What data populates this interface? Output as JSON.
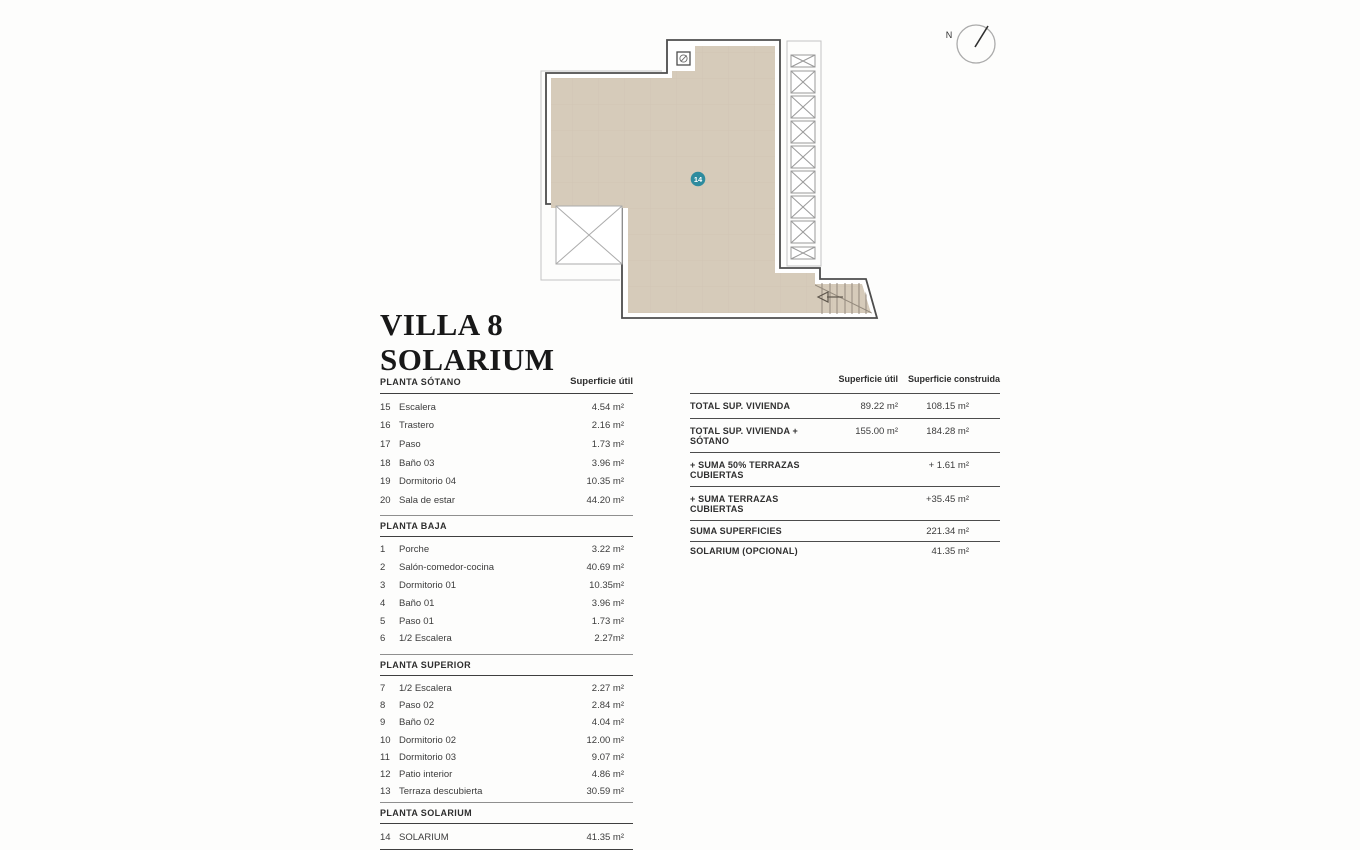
{
  "title": {
    "line1": "VILLA 8",
    "line2": "SOLARIUM"
  },
  "compass": {
    "label": "N"
  },
  "plan": {
    "marker": "14"
  },
  "colors": {
    "floor_fill": "#d6cbba",
    "tile_line": "#cdc1b0",
    "wall_line": "#4d4d4d",
    "light_line": "#bdbdbd",
    "marker_teal": "#2e8b9e"
  },
  "left_table": {
    "col_header": "Superficie útil",
    "sections": [
      {
        "header": "PLANTA SÓTANO",
        "rows": [
          {
            "num": "15",
            "name": "Escalera",
            "value": "4.54 m²"
          },
          {
            "num": "16",
            "name": "Trastero",
            "value": "2.16 m²"
          },
          {
            "num": "17",
            "name": "Paso",
            "value": "1.73 m²"
          },
          {
            "num": "18",
            "name": "Baño 03",
            "value": "3.96 m²"
          },
          {
            "num": "19",
            "name": "Dormitorio 04",
            "value": "10.35 m²"
          },
          {
            "num": "20",
            "name": "Sala de estar",
            "value": "44.20 m²"
          }
        ]
      },
      {
        "header": "PLANTA BAJA",
        "rows": [
          {
            "num": "1",
            "name": "Porche",
            "value": "3.22 m²"
          },
          {
            "num": "2",
            "name": "Salón-comedor-cocina",
            "value": "40.69 m²"
          },
          {
            "num": "3",
            "name": "Dormitorio 01",
            "value": "10.35m²"
          },
          {
            "num": "4",
            "name": "Baño 01",
            "value": "3.96 m²"
          },
          {
            "num": "5",
            "name": "Paso 01",
            "value": "1.73 m²"
          },
          {
            "num": "6",
            "name": "1/2 Escalera",
            "value": "2.27m²"
          }
        ]
      },
      {
        "header": "PLANTA SUPERIOR",
        "rows": [
          {
            "num": "7",
            "name": "1/2 Escalera",
            "value": "2.27 m²"
          },
          {
            "num": "8",
            "name": "Paso 02",
            "value": "2.84 m²"
          },
          {
            "num": "9",
            "name": "Baño 02",
            "value": "4.04 m²"
          },
          {
            "num": "10",
            "name": "Dormitorio 02",
            "value": "12.00 m²"
          },
          {
            "num": "11",
            "name": "Dormitorio 03",
            "value": "9.07 m²"
          },
          {
            "num": "12",
            "name": "Patio interior",
            "value": "4.86 m²"
          },
          {
            "num": "13",
            "name": "Terraza descubierta",
            "value": "30.59 m²"
          }
        ]
      },
      {
        "header": "PLANTA SOLARIUM",
        "rows": [
          {
            "num": "14",
            "name": "SOLARIUM",
            "value": "41.35 m²"
          }
        ]
      }
    ]
  },
  "summary_table": {
    "col1_header": "Superficie útil",
    "col2_header": "Superficie construida",
    "rows": [
      {
        "label": "TOTAL SUP. VIVIENDA",
        "util": "89.22 m²",
        "construida": "108.15 m²"
      },
      {
        "label": "TOTAL SUP. VIVIENDA + SÓTANO",
        "util": "155.00 m²",
        "construida": "184.28 m²"
      },
      {
        "label": "+ SUMA 50% TERRAZAS CUBIERTAS",
        "util": "",
        "construida": "+ 1.61 m²"
      },
      {
        "label": "+ SUMA TERRAZAS CUBIERTAS",
        "util": "",
        "construida": "+35.45 m²"
      },
      {
        "label": "SUMA SUPERFICIES",
        "util": "",
        "construida": "221.34 m²"
      },
      {
        "label": "SOLARIUM (OPCIONAL)",
        "util": "",
        "construida": "41.35 m²"
      }
    ]
  }
}
